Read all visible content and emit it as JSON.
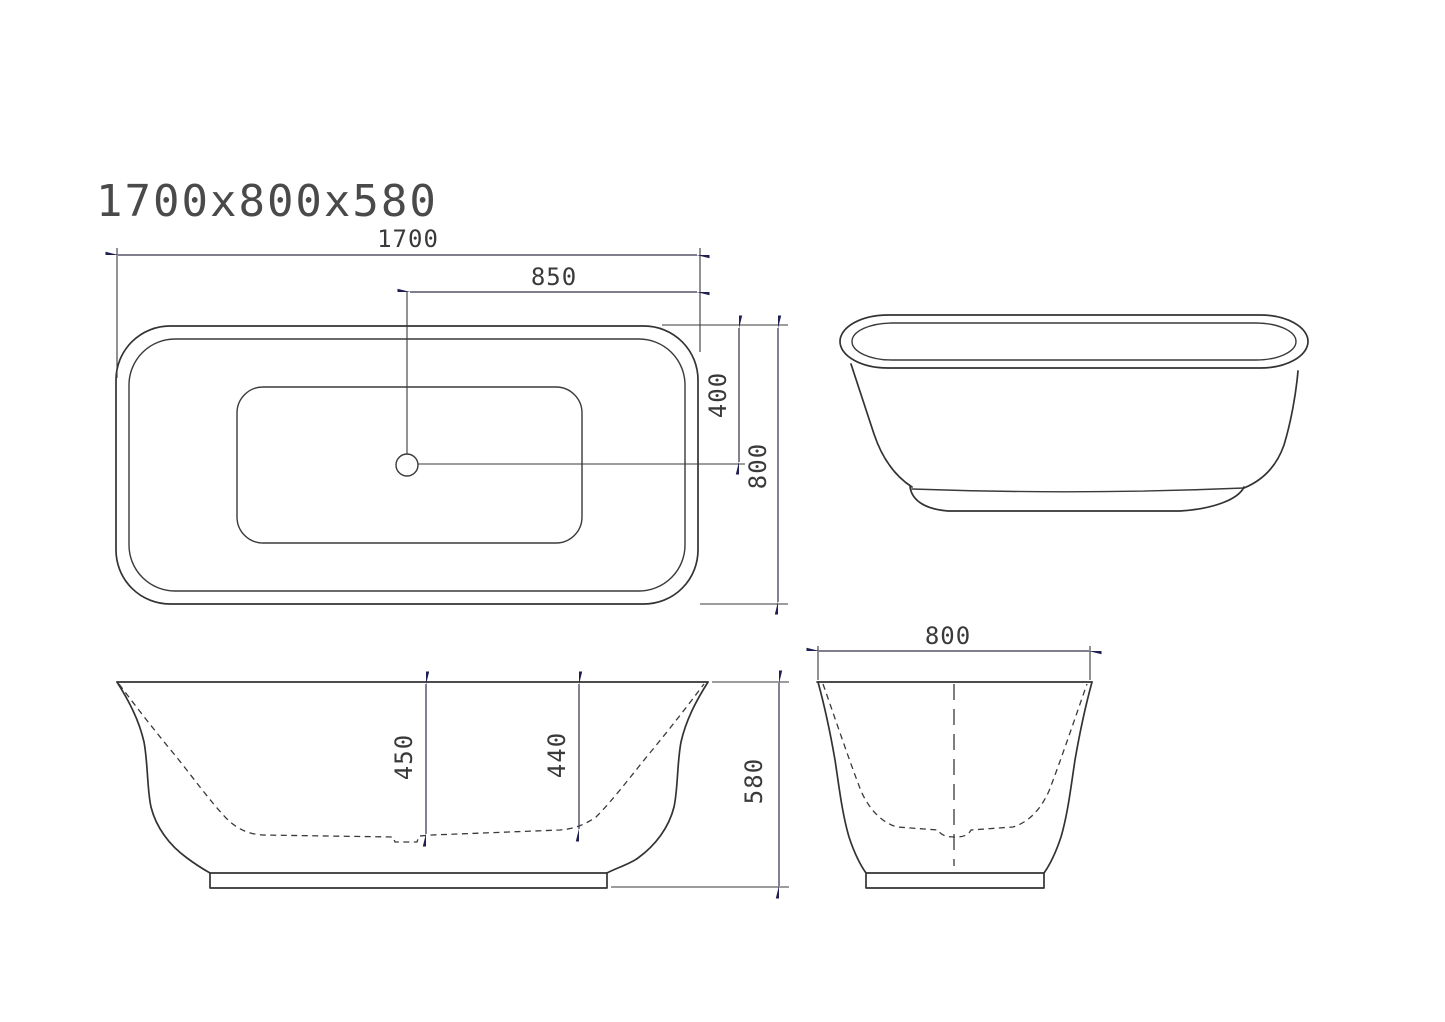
{
  "title": "1700x800x580",
  "colors": {
    "line": "#333333",
    "arrow": "#1f2051",
    "text": "#3a3a3a",
    "background": "#ffffff"
  },
  "views": {
    "top_view": {
      "label": "top view",
      "dims": {
        "overall_length": "1700",
        "drain_to_end": "850",
        "drain_offset": "400",
        "overall_width": "800"
      }
    },
    "side_elevation": {
      "label": "side elevation"
    },
    "long_section": {
      "label": "longitudinal section",
      "dims": {
        "depth_at_drain": "450",
        "inner_depth": "440",
        "overall_height": "580"
      }
    },
    "cross_section": {
      "label": "cross section",
      "dims": {
        "overall_width": "800"
      }
    }
  }
}
